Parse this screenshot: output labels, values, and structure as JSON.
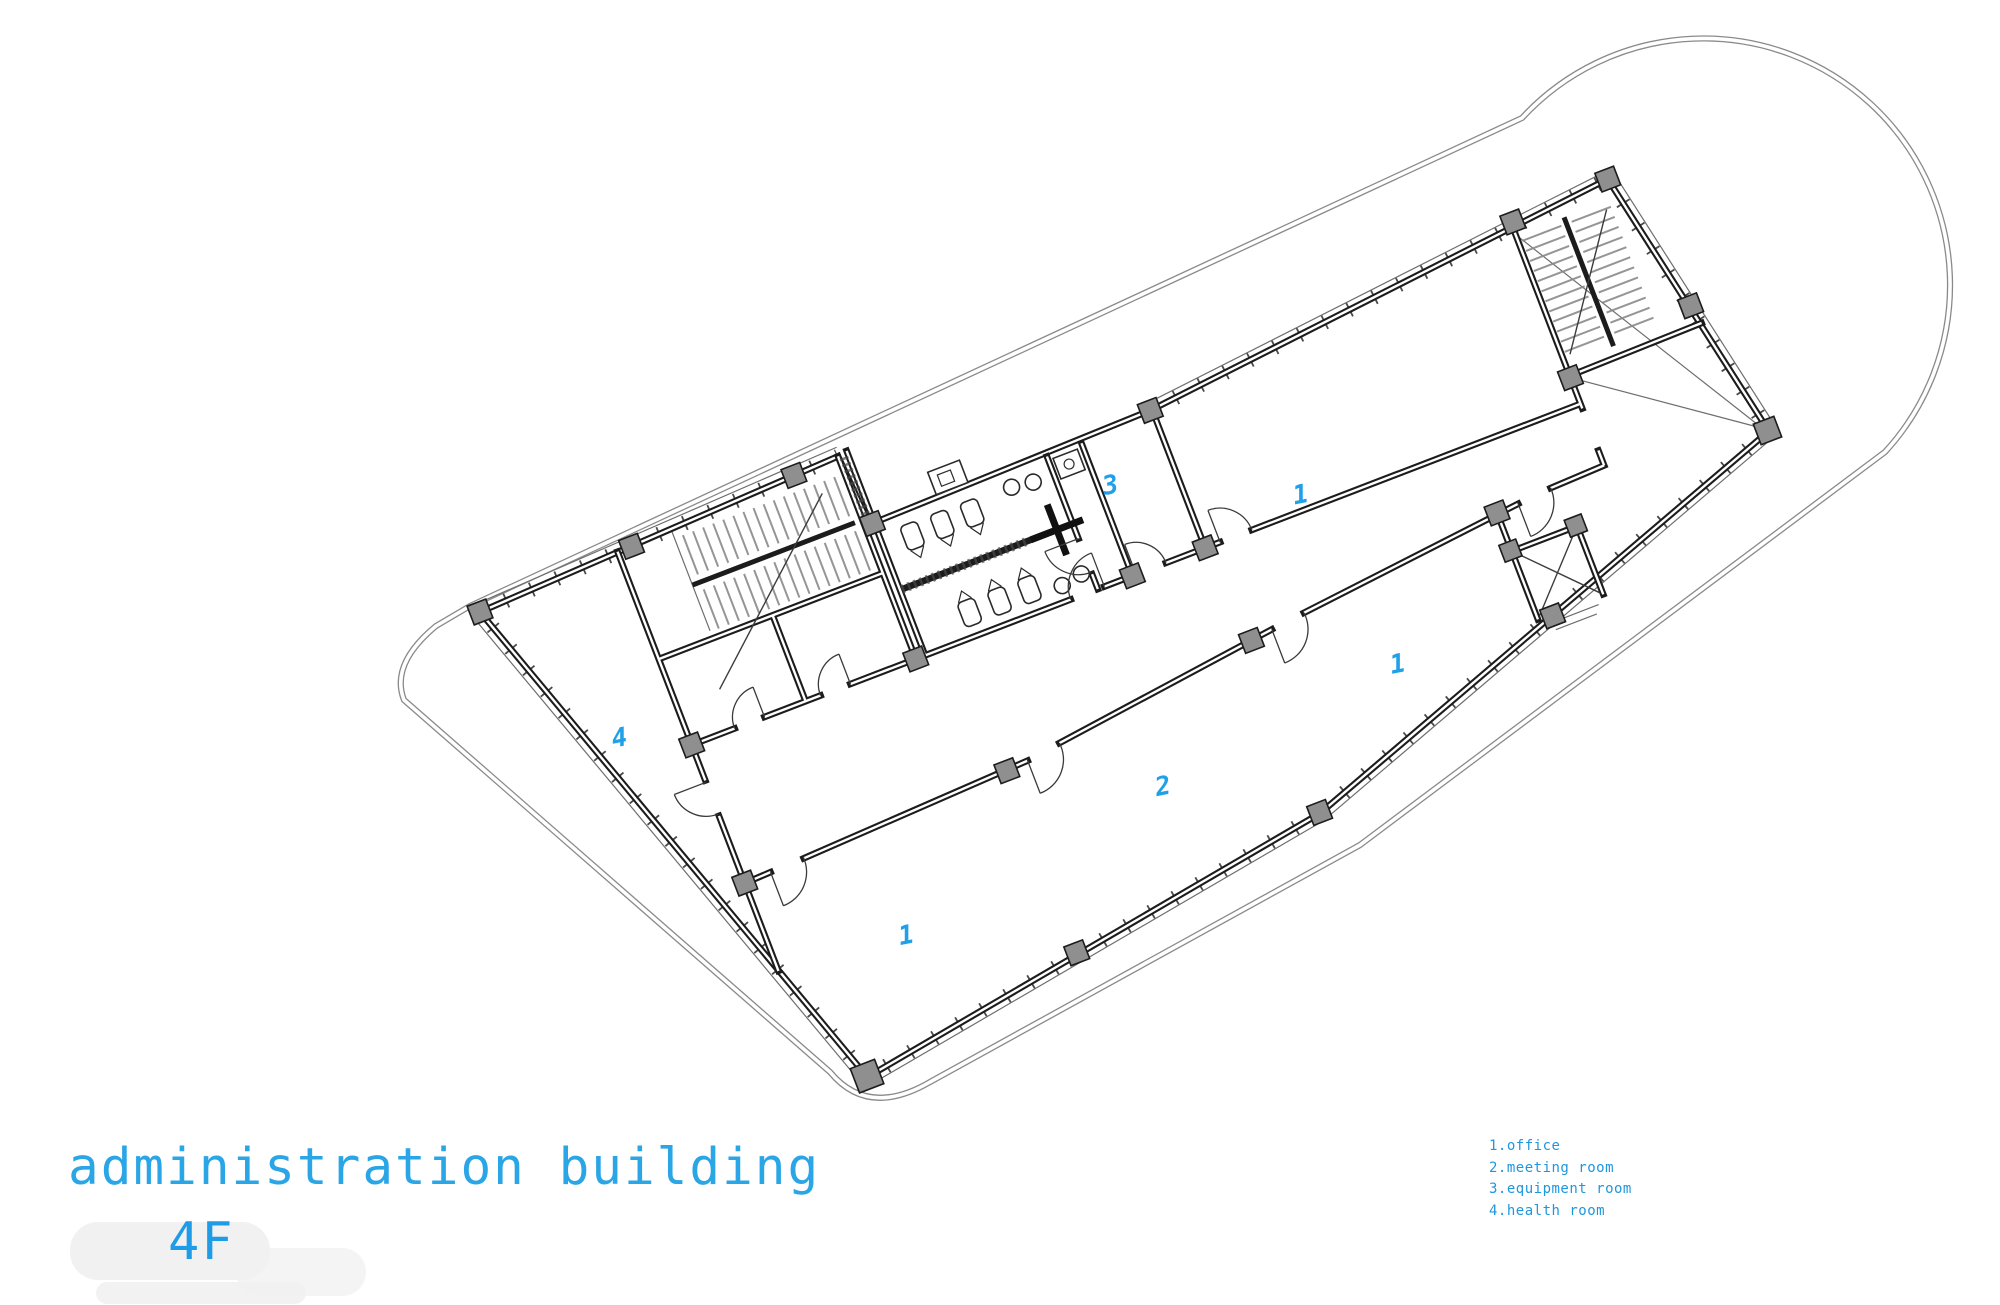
{
  "title": {
    "building_name": "administration building",
    "floor_label": "4F"
  },
  "legend": {
    "items": [
      "1.office",
      "2.meeting room",
      "3.equipment room",
      "4.health room"
    ]
  },
  "plan": {
    "room_numbers": {
      "office_top": "1",
      "office_right": "1",
      "office_bottom_left": "1",
      "meeting_room": "2",
      "equipment_room": "3",
      "health_room": "4"
    },
    "colors": {
      "accent_text": "#2aa5e6",
      "legend_text": "#1f97dd",
      "room_number": "#1fa0e8",
      "walls": "#1c1c1c",
      "columns": "#8f8f8f",
      "envelope": "#8a8a8a"
    }
  }
}
